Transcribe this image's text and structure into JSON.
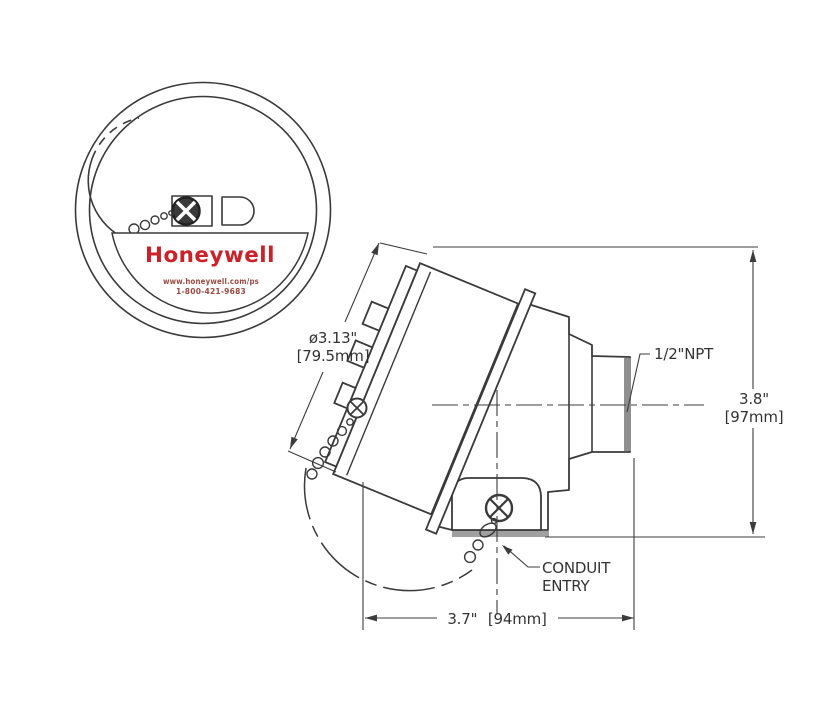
{
  "drawing": {
    "type": "technical-dimension-drawing",
    "front_view": {
      "brand": "Honeywell",
      "website": "www.honeywell.com/ps",
      "phone": "1-800-421-9683"
    },
    "side_view": {
      "labels": {
        "diameter_in": "ø3.13\"",
        "diameter_mm": "[79.5mm]",
        "npt": "1/2\"NPT",
        "height_in": "3.8\"",
        "height_mm": "[97mm]",
        "width": "3.7\" [94mm]",
        "conduit_line1": "CONDUIT",
        "conduit_line2": "ENTRY"
      }
    },
    "colors": {
      "brand_red": "#cc2128",
      "small_red": "#9a4a42",
      "line": "#3a3a3a",
      "thread_shade": "#8f8f8f",
      "shadow": "#a0a0a0"
    }
  }
}
